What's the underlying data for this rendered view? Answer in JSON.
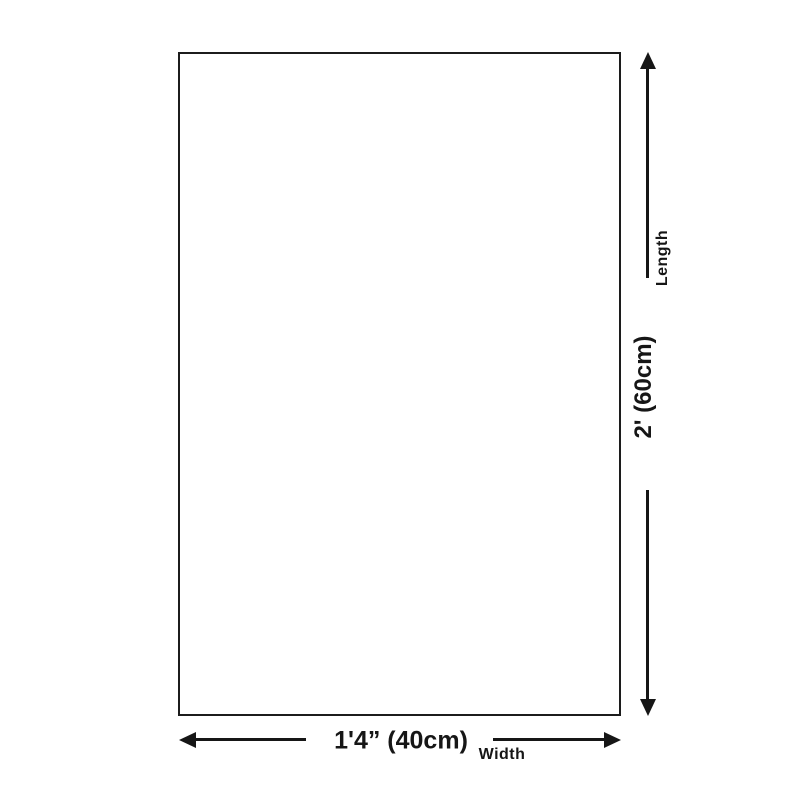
{
  "diagram": {
    "type": "product-size-diagram",
    "colors": {
      "ink": "#161616",
      "outline": "#1c1c1c",
      "background": "#ffffff"
    },
    "product_outline": {
      "shape": "rectangle"
    },
    "length_dimension": {
      "label": "Length",
      "value": "2' (60cm)",
      "orientation": "vertical",
      "arrow_icons": [
        "arrow-up-icon",
        "arrow-down-icon"
      ]
    },
    "width_dimension": {
      "label": "Width",
      "value": "1'4” (40cm)",
      "orientation": "horizontal",
      "arrow_icons": [
        "arrow-left-icon",
        "arrow-right-icon"
      ]
    }
  }
}
